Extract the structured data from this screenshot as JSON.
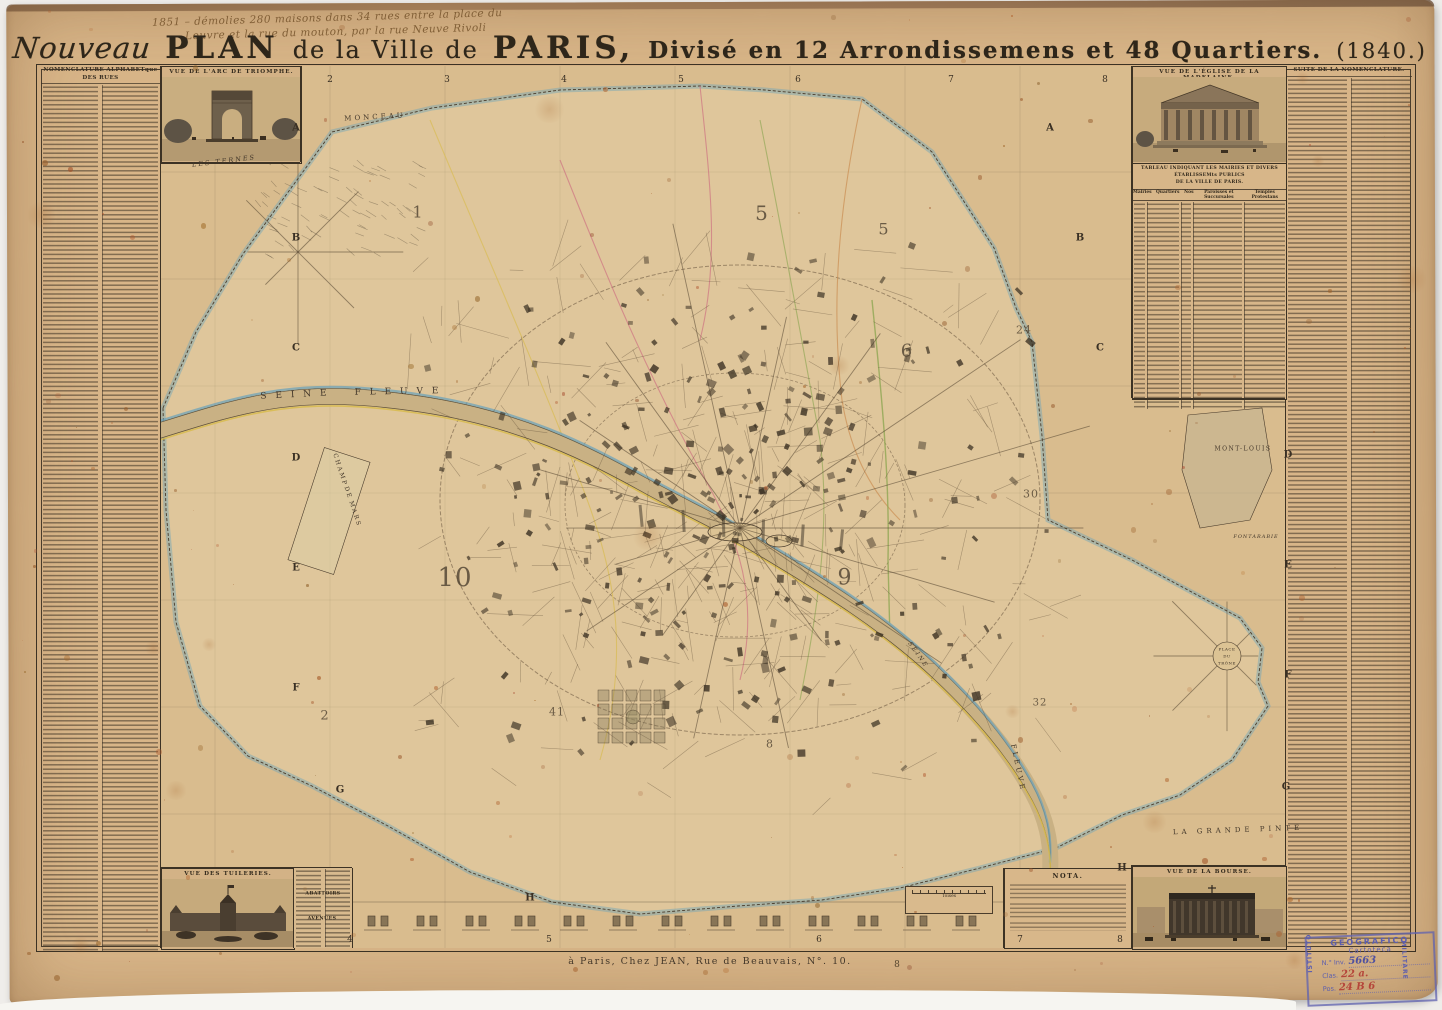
{
  "title": {
    "script_word": "Nouveau",
    "plan": "PLAN",
    "mid": "de la Ville de",
    "paris": "PARIS,",
    "rest": "Divisé en 12 Arrondissemens et 48 Quartiers.",
    "year": "(1840.)"
  },
  "annotation": {
    "line1": "1851 – démolies 280 maisons dans 34 rues entre la place du",
    "line2": "Louvre et la rue du mouton, par la rue Neuve Rivoli"
  },
  "left_column": {
    "header": "NOMENCLATURE ALPHABETque DES RUES",
    "subheader": "RUES."
  },
  "right_column": {
    "header": "SUITE DE LA NOMENCLATURE."
  },
  "mini_headers": [
    {
      "t": "ABATTOIRS",
      "x": 323,
      "y": 894
    },
    {
      "t": "AVENUES",
      "x": 322,
      "y": 919
    }
  ],
  "vignettes": {
    "arc": "VUE DE L'ARC DE TRIOMPHE.",
    "madelaine": "VUE DE L'ÉGLISE DE LA MADELAINE.",
    "tuileries": "VUE DES TUILERIES.",
    "bourse": "VUE DE LA BOURSE."
  },
  "tableau": {
    "title1": "TABLEAU INDIQUANT LES MAIRIES ET DIVERS ÉTABLISSEMts PUBLICS",
    "title2": "DE LA VILLE DE PARIS.",
    "cols": [
      "Mairies",
      "Quartiers",
      "Nos",
      "Paroisses et Succursales",
      "Temples Protestans"
    ]
  },
  "nota": {
    "title": "NOTA."
  },
  "scale_label": "Toises",
  "imprint": "à Paris, Chez JEAN, Rue de Beauvais, N°. 10.",
  "plate_number": "8",
  "stamp": {
    "top": "GEOGRAFICO",
    "left_vertical": "ISTITUTO",
    "right_vertical": "MILITARE",
    "cartoteca": "Cartoteca",
    "inv_label": "N.° Inv.",
    "inv_value": "5663",
    "clas_label": "Clas.",
    "clas_value": "22 a.",
    "pos_label": "Pos.",
    "pos_value": "24 B 6"
  },
  "map": {
    "labels": [
      {
        "t": "MONCEAU",
        "x": 375,
        "y": 117,
        "s": 7,
        "ls": 3,
        "r": -3
      },
      {
        "t": "LES TERNES",
        "x": 224,
        "y": 161,
        "s": 6.5,
        "ls": 2,
        "r": -7,
        "i": true
      },
      {
        "t": "S E I N E",
        "x": 295,
        "y": 395,
        "s": 9,
        "ls": 3,
        "r": -3
      },
      {
        "t": "F L E U V E",
        "x": 398,
        "y": 392,
        "s": 9,
        "ls": 3,
        "r": -1
      },
      {
        "t": "CHAMP",
        "x": 340,
        "y": 470,
        "s": 6,
        "ls": 2,
        "r": 72
      },
      {
        "t": "DE",
        "x": 348,
        "y": 493,
        "s": 6,
        "ls": 2,
        "r": 72
      },
      {
        "t": "MARS",
        "x": 355,
        "y": 514,
        "s": 6,
        "ls": 2,
        "r": 72
      },
      {
        "t": "MONT-LOUIS",
        "x": 1243,
        "y": 449,
        "s": 6,
        "ls": 1.5,
        "r": 0
      },
      {
        "t": "FONTARABIE",
        "x": 1256,
        "y": 537,
        "s": 5,
        "ls": 1,
        "r": 0,
        "i": true
      },
      {
        "t": "LA GRANDE PINTE",
        "x": 1238,
        "y": 830,
        "s": 7,
        "ls": 4,
        "r": -2
      },
      {
        "t": "PLACE",
        "x": 1227,
        "y": 649,
        "s": 4,
        "ls": 0.5,
        "r": 0
      },
      {
        "t": "DU",
        "x": 1227,
        "y": 656,
        "s": 4,
        "ls": 0.5,
        "r": 0
      },
      {
        "t": "TRÔNE",
        "x": 1227,
        "y": 663,
        "s": 4,
        "ls": 0.5,
        "r": 0
      },
      {
        "t": "SEINE",
        "x": 918,
        "y": 655,
        "s": 6,
        "ls": 2,
        "r": 55,
        "i": true
      },
      {
        "t": "FLEUVE",
        "x": 1018,
        "y": 768,
        "s": 7,
        "ls": 3,
        "r": 78
      }
    ],
    "district_numbers": [
      {
        "n": "1",
        "x": 418,
        "y": 212,
        "s": 16
      },
      {
        "n": "5",
        "x": 762,
        "y": 213,
        "s": 20
      },
      {
        "n": "5",
        "x": 884,
        "y": 229,
        "s": 16
      },
      {
        "n": "6",
        "x": 907,
        "y": 351,
        "s": 18
      },
      {
        "n": "24",
        "x": 1024,
        "y": 330,
        "s": 11
      },
      {
        "n": "30",
        "x": 1031,
        "y": 494,
        "s": 11
      },
      {
        "n": "10",
        "x": 455,
        "y": 578,
        "s": 26
      },
      {
        "n": "9",
        "x": 845,
        "y": 578,
        "s": 22
      },
      {
        "n": "41",
        "x": 557,
        "y": 712,
        "s": 11
      },
      {
        "n": "32",
        "x": 1040,
        "y": 703,
        "s": 10
      },
      {
        "n": "2",
        "x": 325,
        "y": 716,
        "s": 13
      },
      {
        "n": "8",
        "x": 770,
        "y": 744,
        "s": 11
      }
    ],
    "margin_letters_left": [
      {
        "t": "A",
        "x": 296,
        "y": 128
      },
      {
        "t": "B",
        "x": 296,
        "y": 238
      },
      {
        "t": "C",
        "x": 296,
        "y": 348
      },
      {
        "t": "D",
        "x": 296,
        "y": 458
      },
      {
        "t": "E",
        "x": 296,
        "y": 568
      },
      {
        "t": "F",
        "x": 296,
        "y": 688
      },
      {
        "t": "G",
        "x": 340,
        "y": 790
      },
      {
        "t": "H",
        "x": 530,
        "y": 898
      }
    ],
    "margin_letters_right": [
      {
        "t": "A",
        "x": 1050,
        "y": 128
      },
      {
        "t": "B",
        "x": 1080,
        "y": 238
      },
      {
        "t": "C",
        "x": 1100,
        "y": 348
      },
      {
        "t": "D",
        "x": 1288,
        "y": 455
      },
      {
        "t": "E",
        "x": 1288,
        "y": 565
      },
      {
        "t": "F",
        "x": 1288,
        "y": 675
      },
      {
        "t": "G",
        "x": 1286,
        "y": 787
      },
      {
        "t": "H",
        "x": 1122,
        "y": 868
      }
    ],
    "top_numbers": [
      {
        "t": "2",
        "x": 330
      },
      {
        "t": "3",
        "x": 447
      },
      {
        "t": "4",
        "x": 564
      },
      {
        "t": "5",
        "x": 681
      },
      {
        "t": "6",
        "x": 798
      },
      {
        "t": "7",
        "x": 951
      },
      {
        "t": "8",
        "x": 1105
      }
    ],
    "bottom_numbers": [
      {
        "t": "4",
        "x": 350
      },
      {
        "t": "5",
        "x": 549
      },
      {
        "t": "6",
        "x": 819
      },
      {
        "t": "7",
        "x": 1020
      },
      {
        "t": "8",
        "x": 1120
      }
    ]
  },
  "colors": {
    "paper": "#d8b588",
    "map_ground": "#d9bc8e",
    "ink": "#3c3224",
    "river_blue": "#6fa3b8",
    "edge_yellow": "#d8bb4e",
    "boundary_blue": "#6fa3b8",
    "district_pink": "#cd6e80",
    "district_yellow": "#d8bb4e",
    "district_green": "#8fa653",
    "district_orange": "#c98a4d",
    "stamp_purple": "#5c5eae",
    "stamp_red": "#b5453a"
  }
}
